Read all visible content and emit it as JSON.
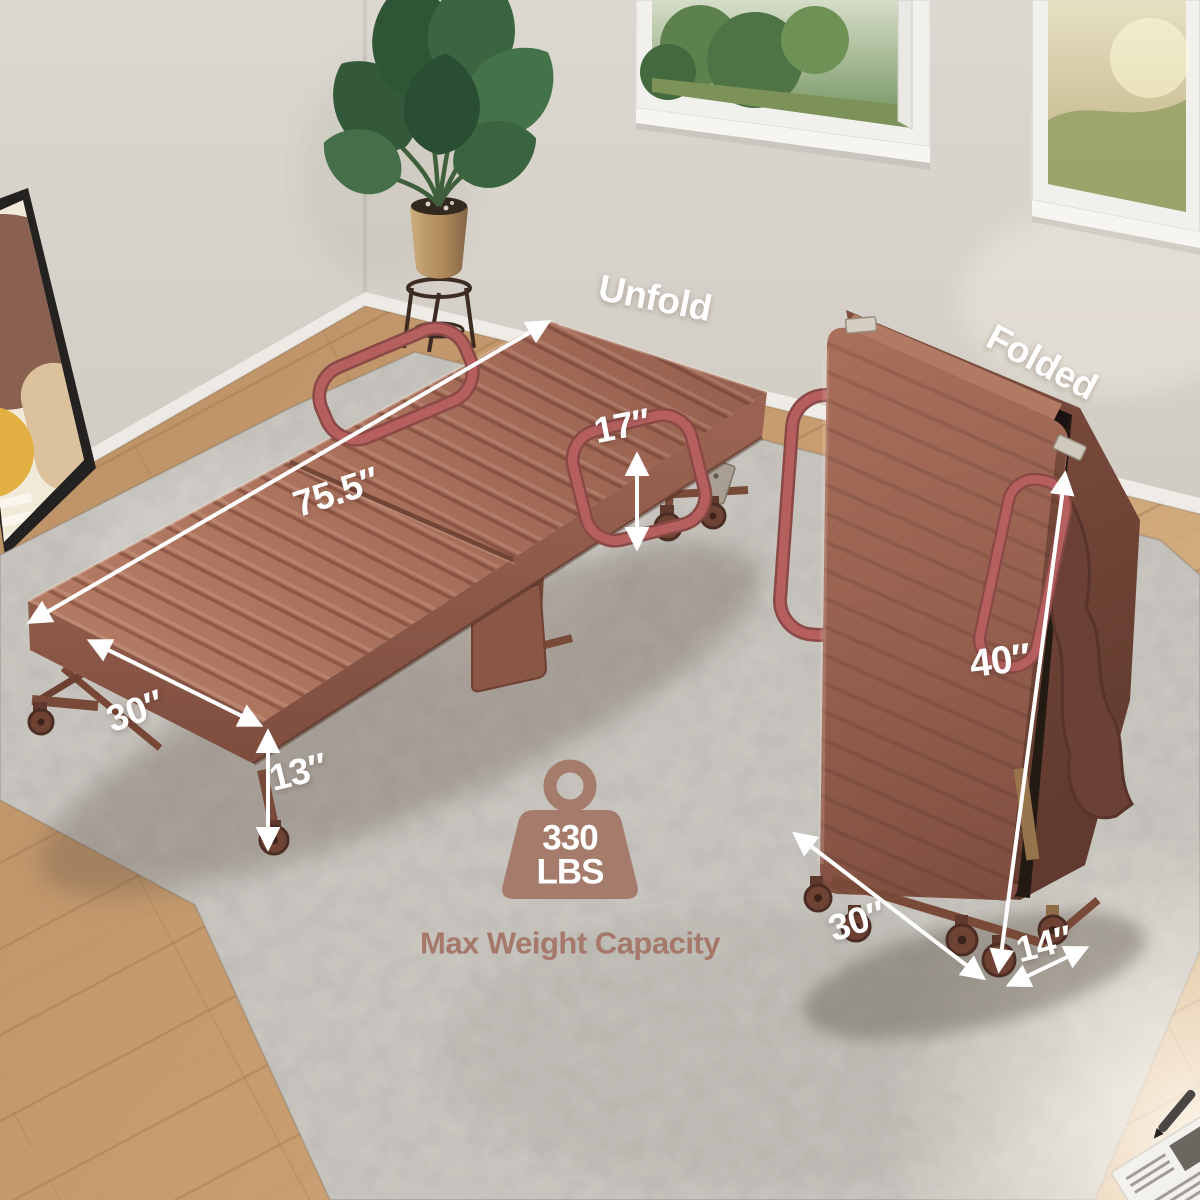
{
  "product_scene": {
    "state_labels": {
      "unfold": "Unfold",
      "folded": "Folded"
    },
    "dimensions": {
      "unfolded_length": "75.5″",
      "unfolded_width": "30″",
      "rail_height": "17″",
      "bed_height": "13″",
      "folded_height": "40″",
      "folded_depth": "30″",
      "folded_width": "14″"
    },
    "weight_capacity": {
      "value": "330",
      "unit": "LBS",
      "caption": "Max Weight Capacity"
    },
    "icons": {
      "weight": "weight-icon"
    },
    "colors": {
      "annotation_text": "#ffffff",
      "accent_brown": "#a57c6c",
      "mattress": "#a86f5b",
      "handle": "#b5605f",
      "rug": "#c9c6c0",
      "wood_floor": "#c59b6e",
      "wall": "#d8d4cd"
    }
  }
}
